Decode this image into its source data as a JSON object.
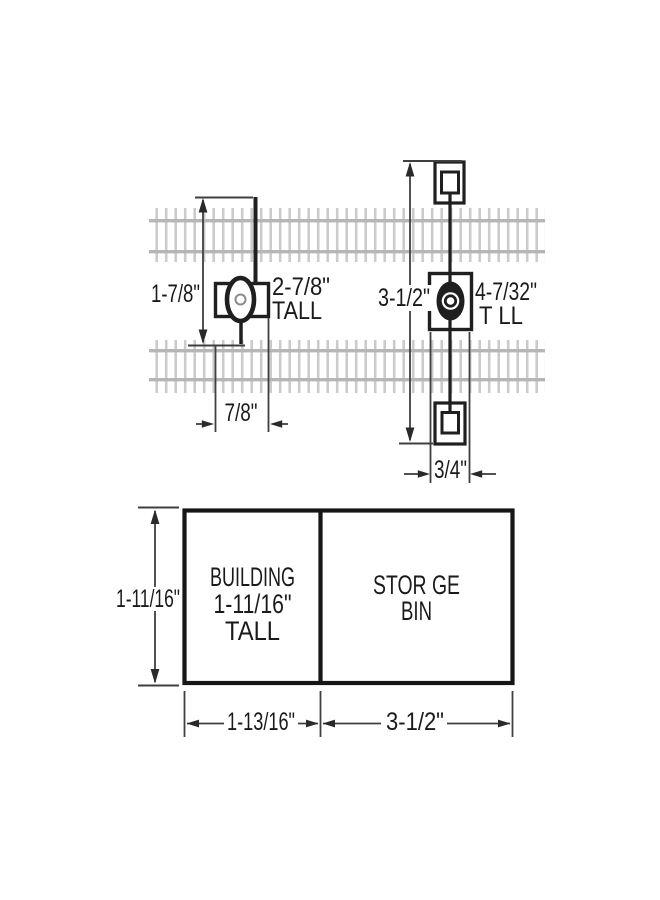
{
  "colors": {
    "background": "#ffffff",
    "line": "#1f1f1f",
    "dimension_line": "#3f3f3f",
    "tie": "#cbcbcb",
    "rail": "#b6b6b6",
    "text": "#1a1a1a"
  },
  "top_diagram": {
    "left_signal": {
      "height_label": "1-7/8\"",
      "tall_line1": "2-7/8\"",
      "tall_line2": "TALL",
      "width_label": "7/8\""
    },
    "right_signal": {
      "height_label": "3-1/2\"",
      "tall_line1": "4-7/32\"",
      "tall_line2": "T LL",
      "width_label": "3/4\""
    }
  },
  "bottom_diagram": {
    "building": {
      "line1": "BUILDING",
      "line2": "1-11/16\"",
      "line3": "TALL"
    },
    "bin": {
      "line1": "STOR GE",
      "line2": "BIN"
    },
    "height_label": "1-11/16\"",
    "building_width_label": "1-13/16\"",
    "bin_width_label": "3-1/2\""
  }
}
